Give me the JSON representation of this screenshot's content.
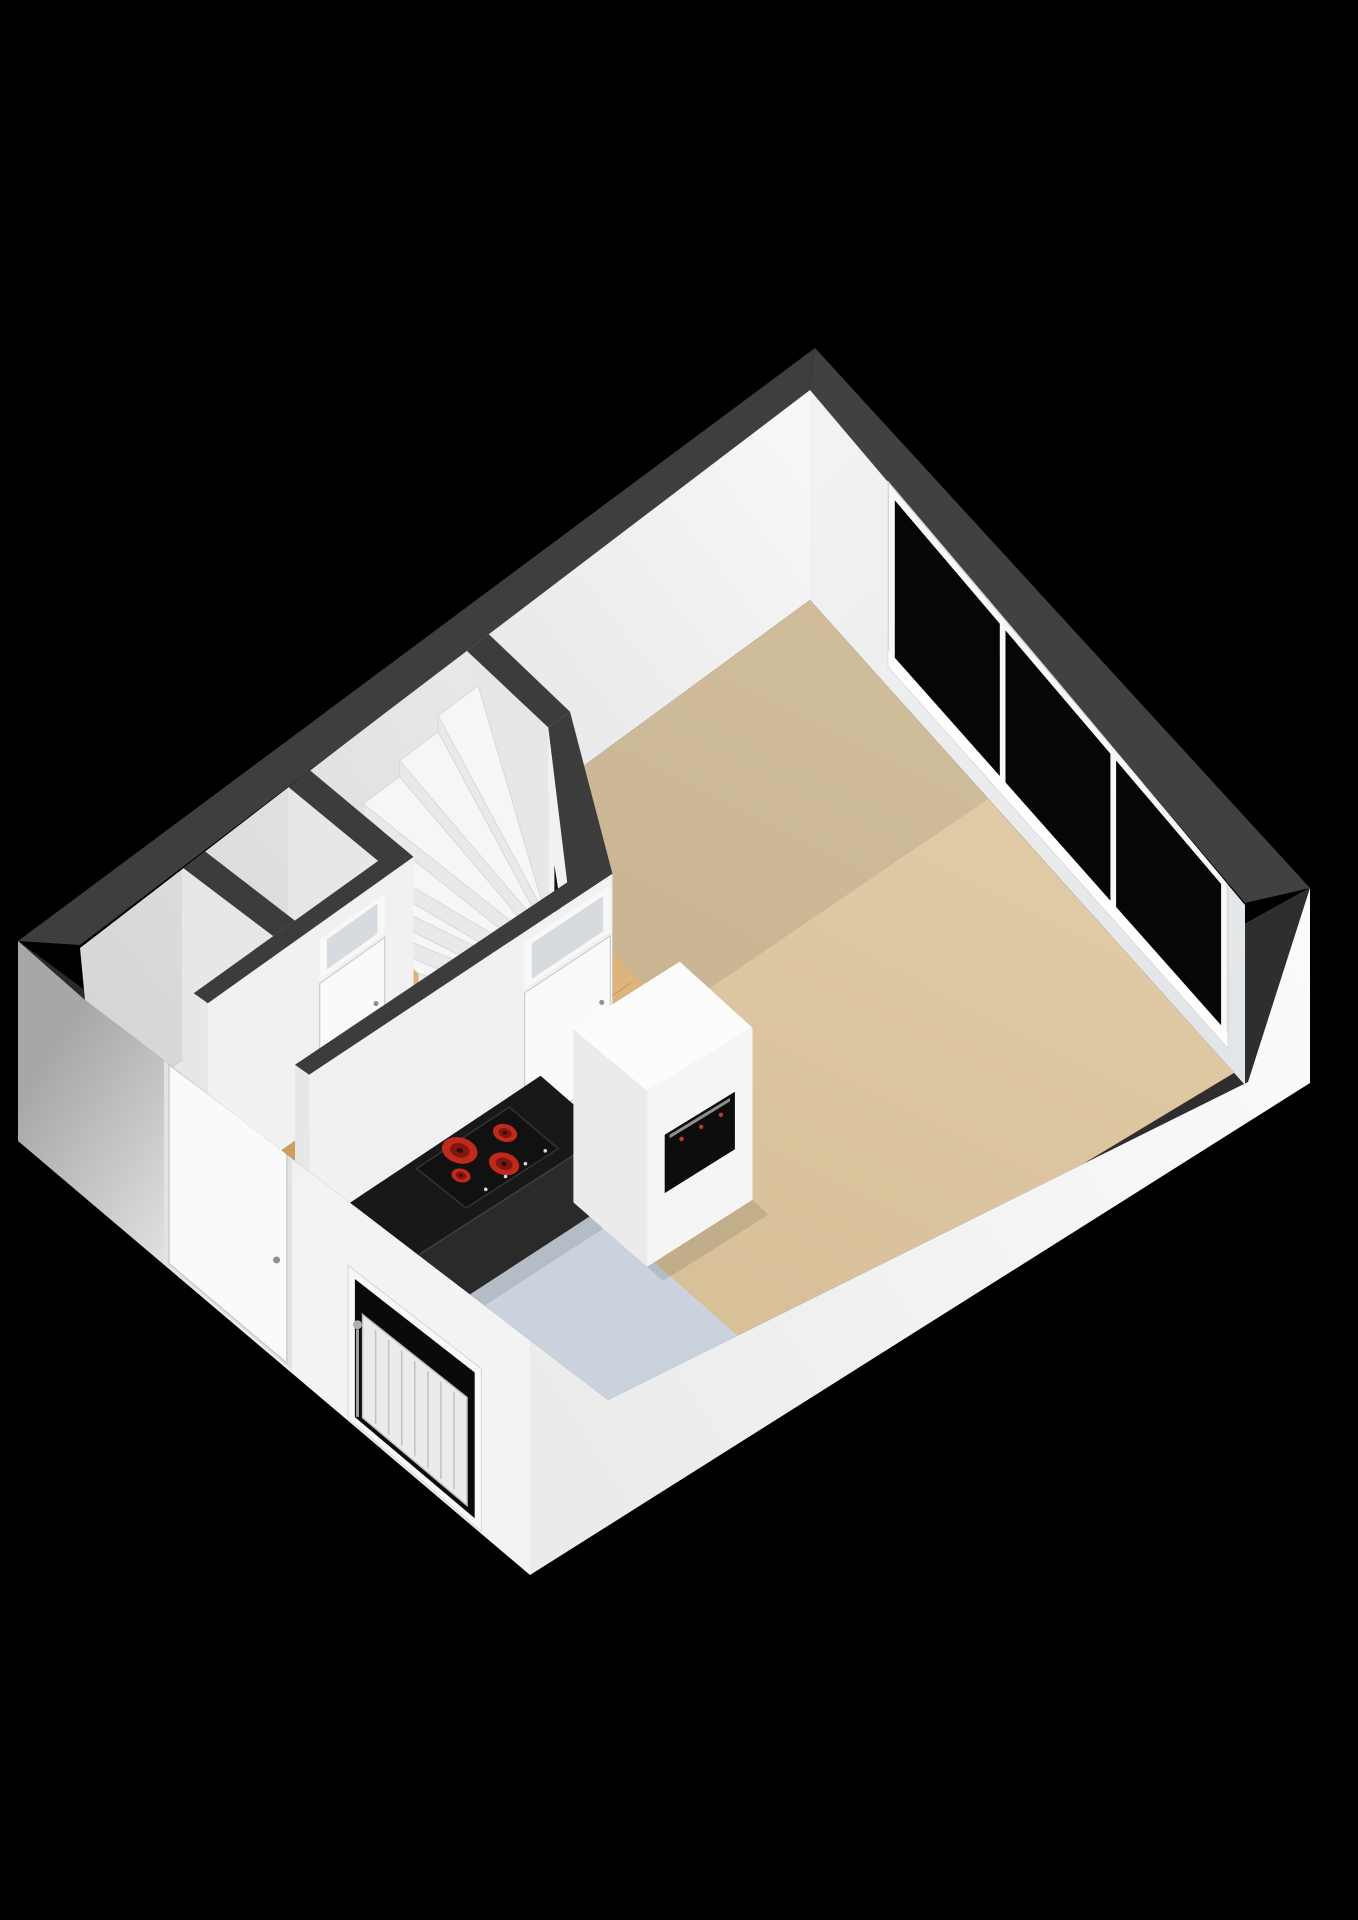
{
  "scene": {
    "kind": "3d-floorplan-render",
    "view": "isometric cutaway from above on black background",
    "visible_text": ""
  },
  "palette": {
    "background": "#000000",
    "ring_ne": "#414141",
    "ring_se": "#2e2e2e",
    "ring_sw": "#2a2a2a",
    "ring_nw": "#3e3e3e",
    "wall_cap": "#3c3c3c",
    "face_nw_light": "#f7f7f7",
    "face_nw_dark": "#d6d6d6",
    "face_ne_light": "#f2f2f2",
    "face_ne_dark": "#e3e6e8",
    "face_a": "#f1f1f1",
    "face_b": "#e7e7e7",
    "facade_sw_dark": "#a7a7a7",
    "facade_sw_light": "#f3f3f3",
    "facade_se_light": "#fbfbfb",
    "facade_se_dark": "#ebebeb",
    "floor_tan_light": "#e2cda9",
    "floor_tan_dark": "#d5bd94",
    "wood_light": "#dcb47c",
    "wood_dark": "#c4924f",
    "floor_kitchen": "#c9d2dd",
    "floor_toilet": "#ebebeb",
    "floor_storage": "#e7e7e7",
    "stair_tread": "#f6f6f6",
    "stair_riser": "#e9e9e9",
    "stair_stroke": "#d8d8d8",
    "glass_dark": "#060606",
    "transom_glass": "#d7dbdf",
    "frame_white": "#f8f8f8",
    "frame_stroke": "#d6d6d6",
    "door_white": "#fafafa",
    "door_stroke": "#cccccc",
    "handle_gray": "#8f8f8f",
    "counter_top": "#181818",
    "counter_front": "#2a2a2a",
    "counter_edge": "#404040",
    "counter_end": "#e9e9e9",
    "hob_black": "#111111",
    "hob_stroke": "#333333",
    "burner_red": "#c1291c",
    "burner_mid": "#7e170e",
    "burner_core": "#2e0a06",
    "control_dot": "#d8d8d8",
    "cabinet_top": "#fcfcfc",
    "cabinet_front": "#f5f5f5",
    "cabinet_side": "#ebebeb",
    "oven_black": "#0d0d0d",
    "oven_handle": "#909090",
    "oven_knob_red": "#c0392b",
    "meter_dark": "#161616",
    "meter_red": "#b23026",
    "niche_dark": "#141414",
    "radiator_white": "#ebebeb",
    "radiator_line": "#c2c2c2",
    "radiator_valve": "#b0b0b0",
    "radiator_pipe": "#9f9f9f",
    "cistern_top": "#f3f3f3",
    "cistern_front": "#ececec",
    "cistern_side": "#e3e3e3",
    "window_sill": "#fdfdfd",
    "soft_shadow": "rgba(0,0,0,0.10)"
  },
  "living_room": {
    "window_pane_count": 3
  },
  "kitchen": {
    "cooktop_burner_count": 4,
    "cooktop_control_dot_count": 4,
    "oven_knob_count": 3
  },
  "staircase": {
    "visible_step_count": 10
  },
  "facade": {
    "front_door_count": 1,
    "kitchen_window_radiator_fin_count": 7
  },
  "meter_cupboard": {
    "meter_count": 3
  }
}
